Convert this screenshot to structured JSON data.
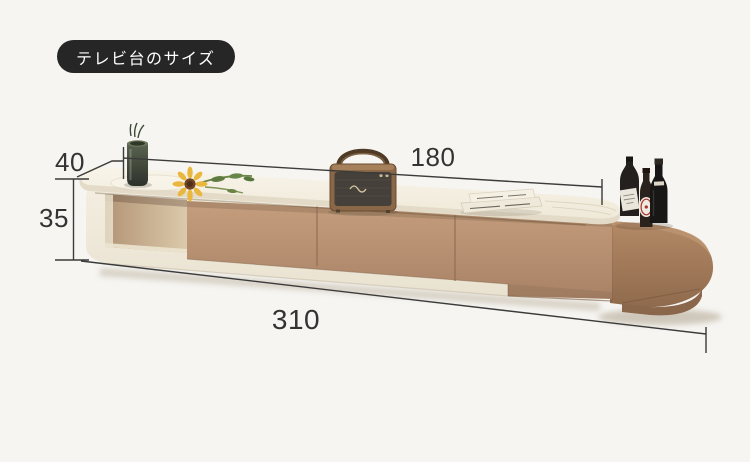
{
  "page": {
    "background": "#f6f5f2"
  },
  "badge": {
    "label": "テレビ台のサイズ"
  },
  "dimensions": {
    "depth": "40",
    "height": "35",
    "top_length": "180",
    "total_length": "310"
  },
  "colors": {
    "badge_bg": "#262626",
    "badge_text": "#ffffff",
    "dimension_line": "#3b3b3b",
    "dimension_text": "#333333",
    "cream_body": "#f1ebdd",
    "drawer_tan": "#b78e6d",
    "extendable_brown": "#a87e5e",
    "background": "#f6f5f2"
  }
}
